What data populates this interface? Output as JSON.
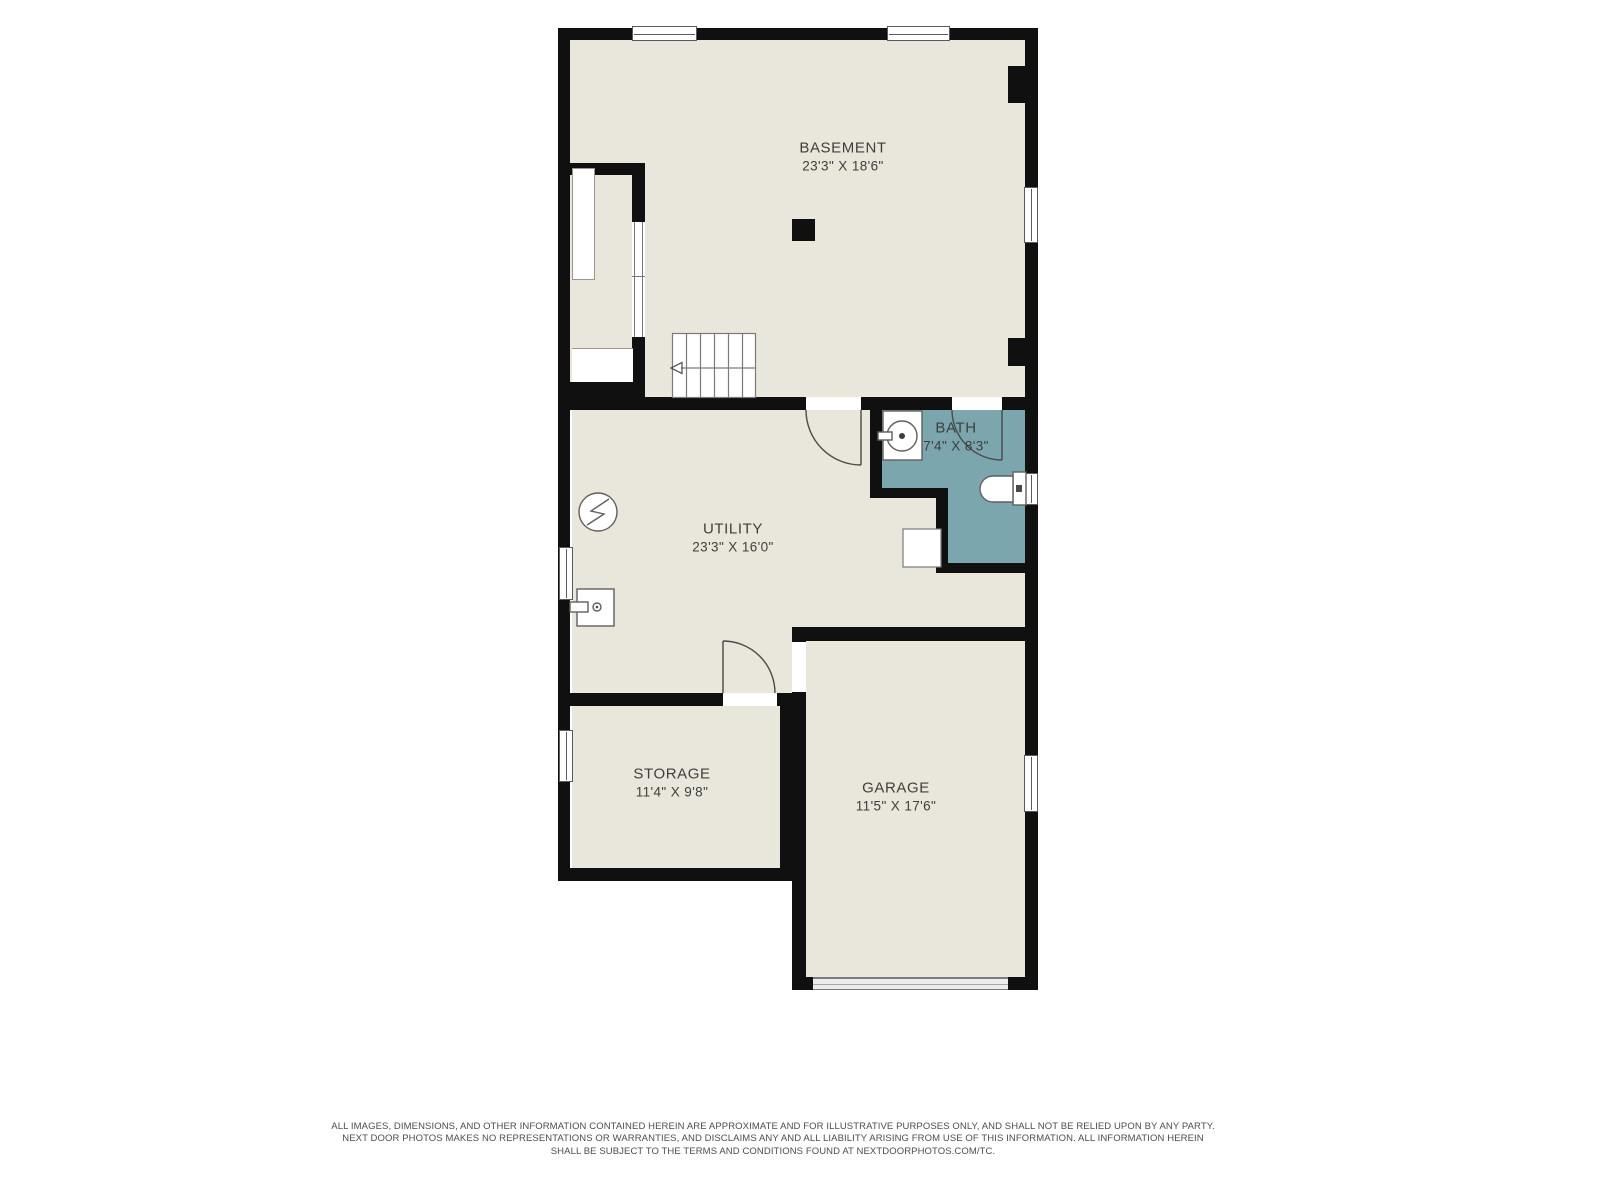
{
  "colors": {
    "wall": "#101010",
    "floor": "#e9e7db",
    "bath": "#7ca6ae",
    "label": "#3e3e3e"
  },
  "plan_title": "Basement floor plan",
  "rooms": [
    {
      "name": "BASEMENT",
      "dims": "23'3\" X 18'6\""
    },
    {
      "name": "UTILITY",
      "dims": "23'3\" X 16'0\""
    },
    {
      "name": "BATH",
      "dims": "7'4\" X 8'3\""
    },
    {
      "name": "STORAGE",
      "dims": "11'4\" X 9'8\""
    },
    {
      "name": "GARAGE",
      "dims": "11'5\" X 17'6\""
    }
  ],
  "fixtures": [
    "stairs-down-arrow",
    "electrical-panel",
    "water-heater",
    "bath-sink",
    "toilet",
    "laundry-appliance",
    "support-column",
    "garage-door"
  ],
  "disclaimer": {
    "lines": [
      "ALL IMAGES, DIMENSIONS, AND OTHER INFORMATION CONTAINED HEREIN ARE APPROXIMATE AND FOR ILLUSTRATIVE PURPOSES ONLY, AND SHALL NOT BE RELIED UPON BY ANY PARTY.",
      "NEXT DOOR PHOTOS MAKES NO REPRESENTATIONS OR WARRANTIES, AND DISCLAIMS ANY AND ALL LIABILITY ARISING FROM USE OF THIS INFORMATION. ALL INFORMATION HEREIN",
      "SHALL BE SUBJECT TO THE TERMS AND CONDITIONS FOUND AT NEXTDOORPHOTOS.COM/TC."
    ]
  }
}
